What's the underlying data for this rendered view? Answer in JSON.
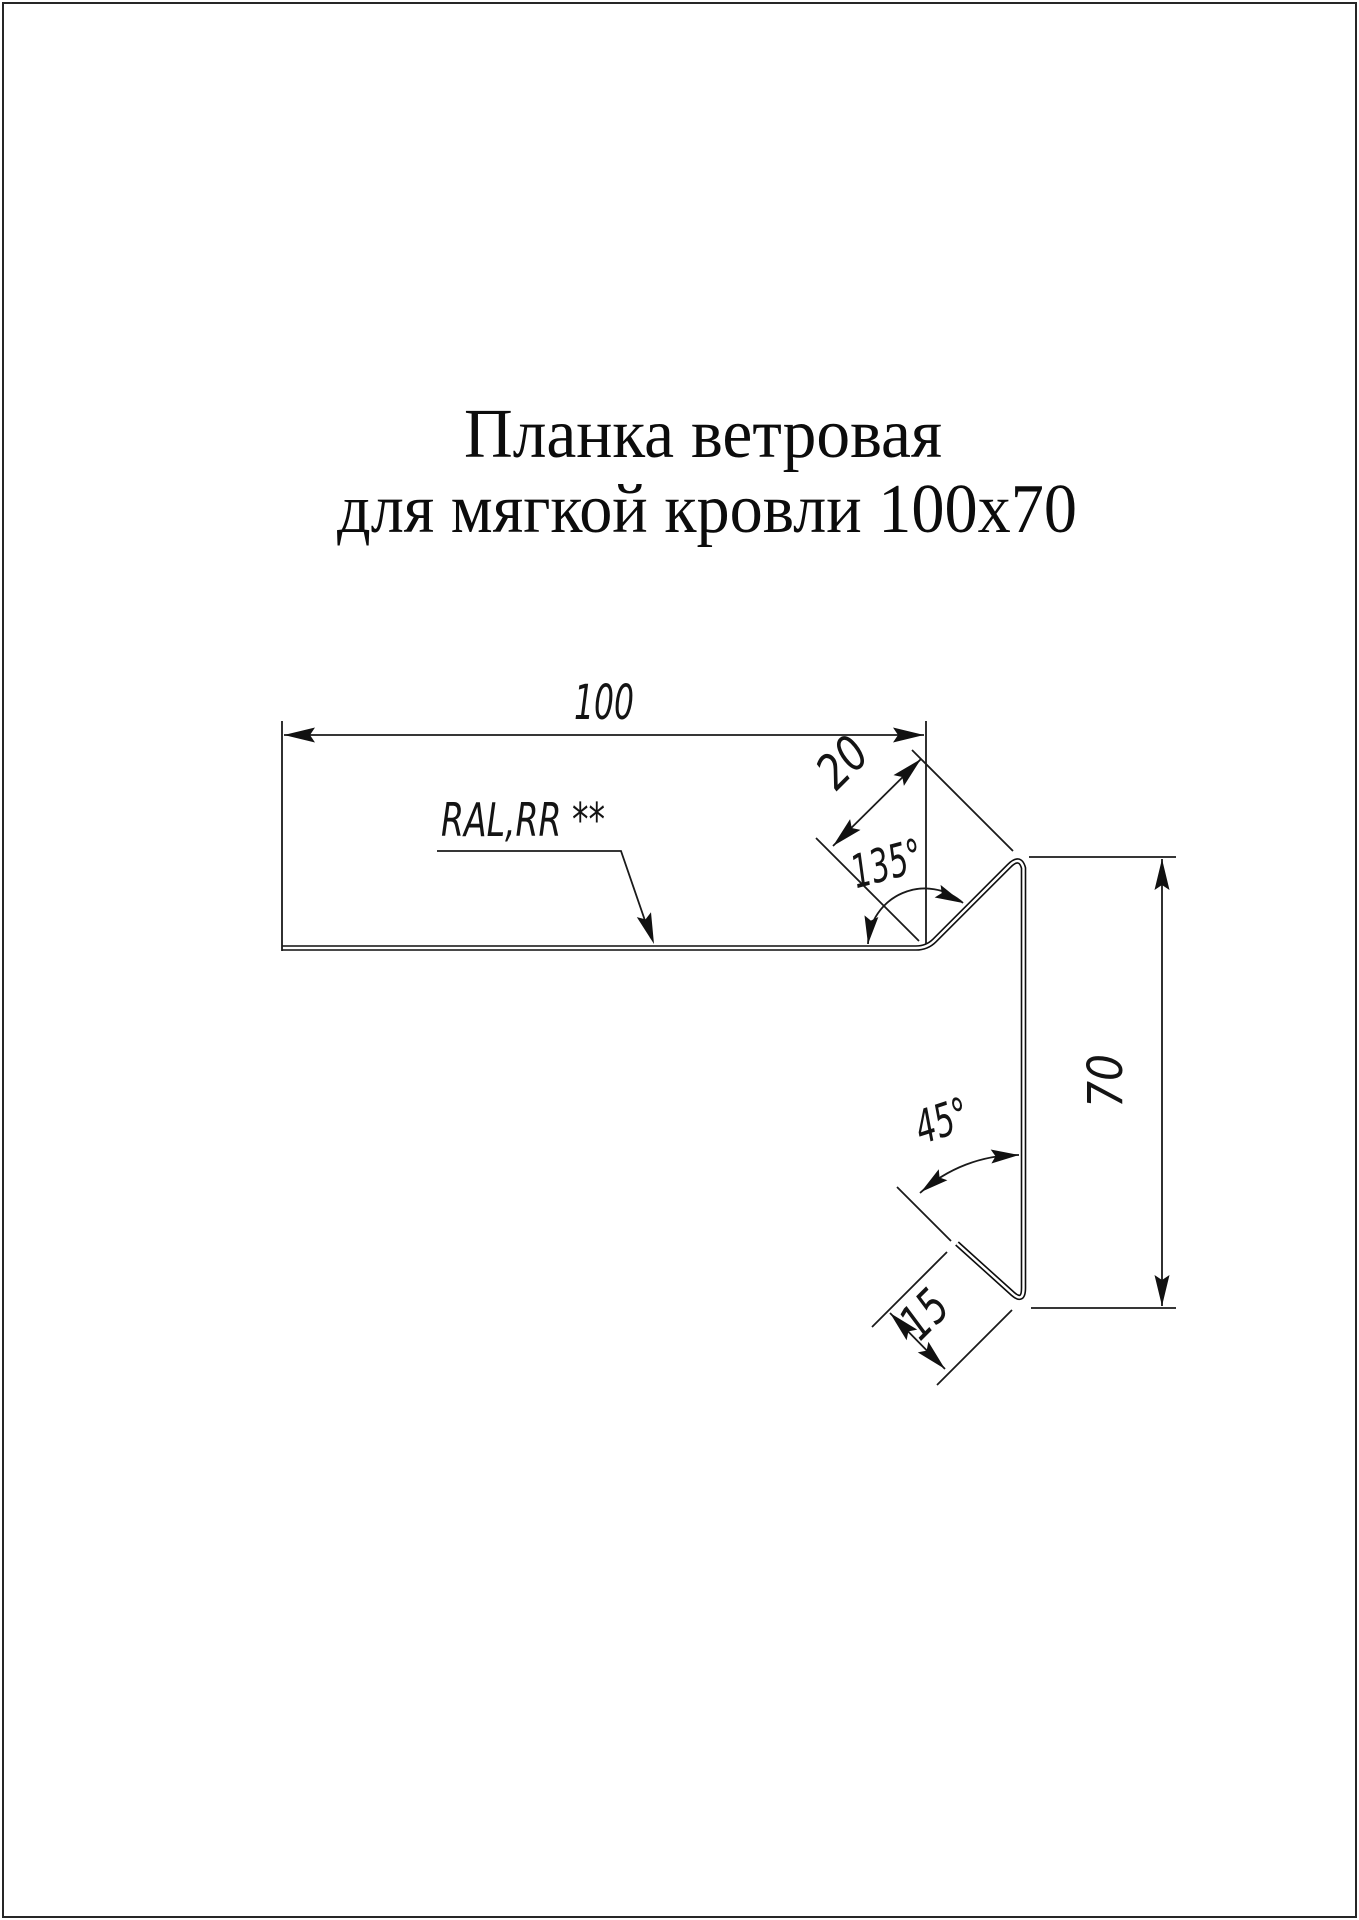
{
  "page": {
    "background": "#ffffff",
    "border_color": "#262626",
    "line_color": "#1a1a1a"
  },
  "title": {
    "line1": "Планка ветровая",
    "line2": "для мягкой кровли 100х70"
  },
  "drawing": {
    "material_label": "RAL,RR **",
    "dimensions": {
      "top_width": "100",
      "top_flange": "20",
      "right_height": "70",
      "bottom_hem": "15"
    },
    "angles": {
      "top_bend": "135°",
      "bottom_hem": "45°"
    }
  }
}
